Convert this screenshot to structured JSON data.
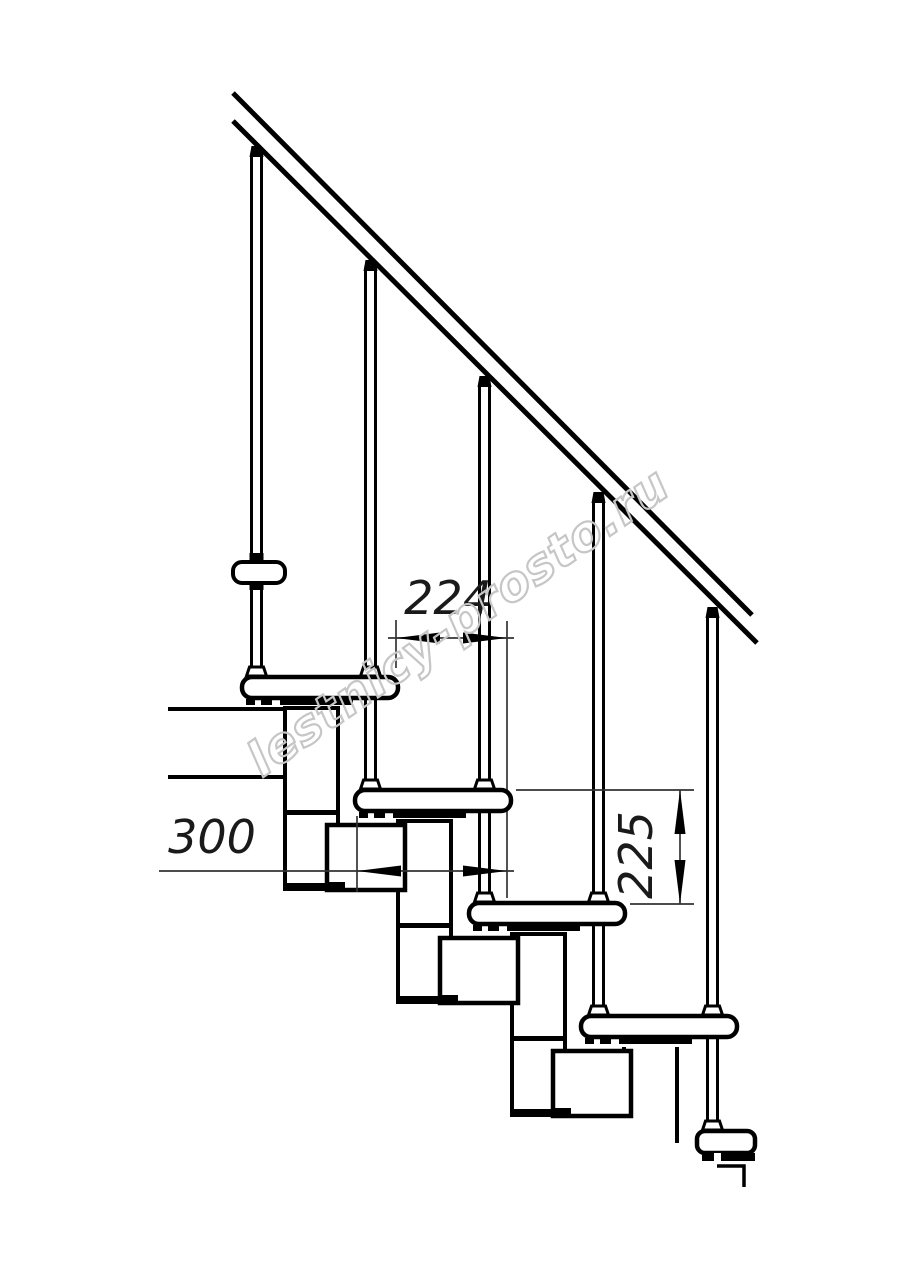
{
  "drawing": {
    "dimension_labels": {
      "step_run_horizontal": "224",
      "tread_depth_horizontal": "300",
      "riser_height_vertical": "225"
    },
    "watermark_text": "lestnicy-prosto.ru",
    "colors": {
      "main_line": "#000000",
      "thin_dimension_line": "#333333",
      "watermark": "#c6c6c6",
      "background": "#ffffff"
    }
  }
}
